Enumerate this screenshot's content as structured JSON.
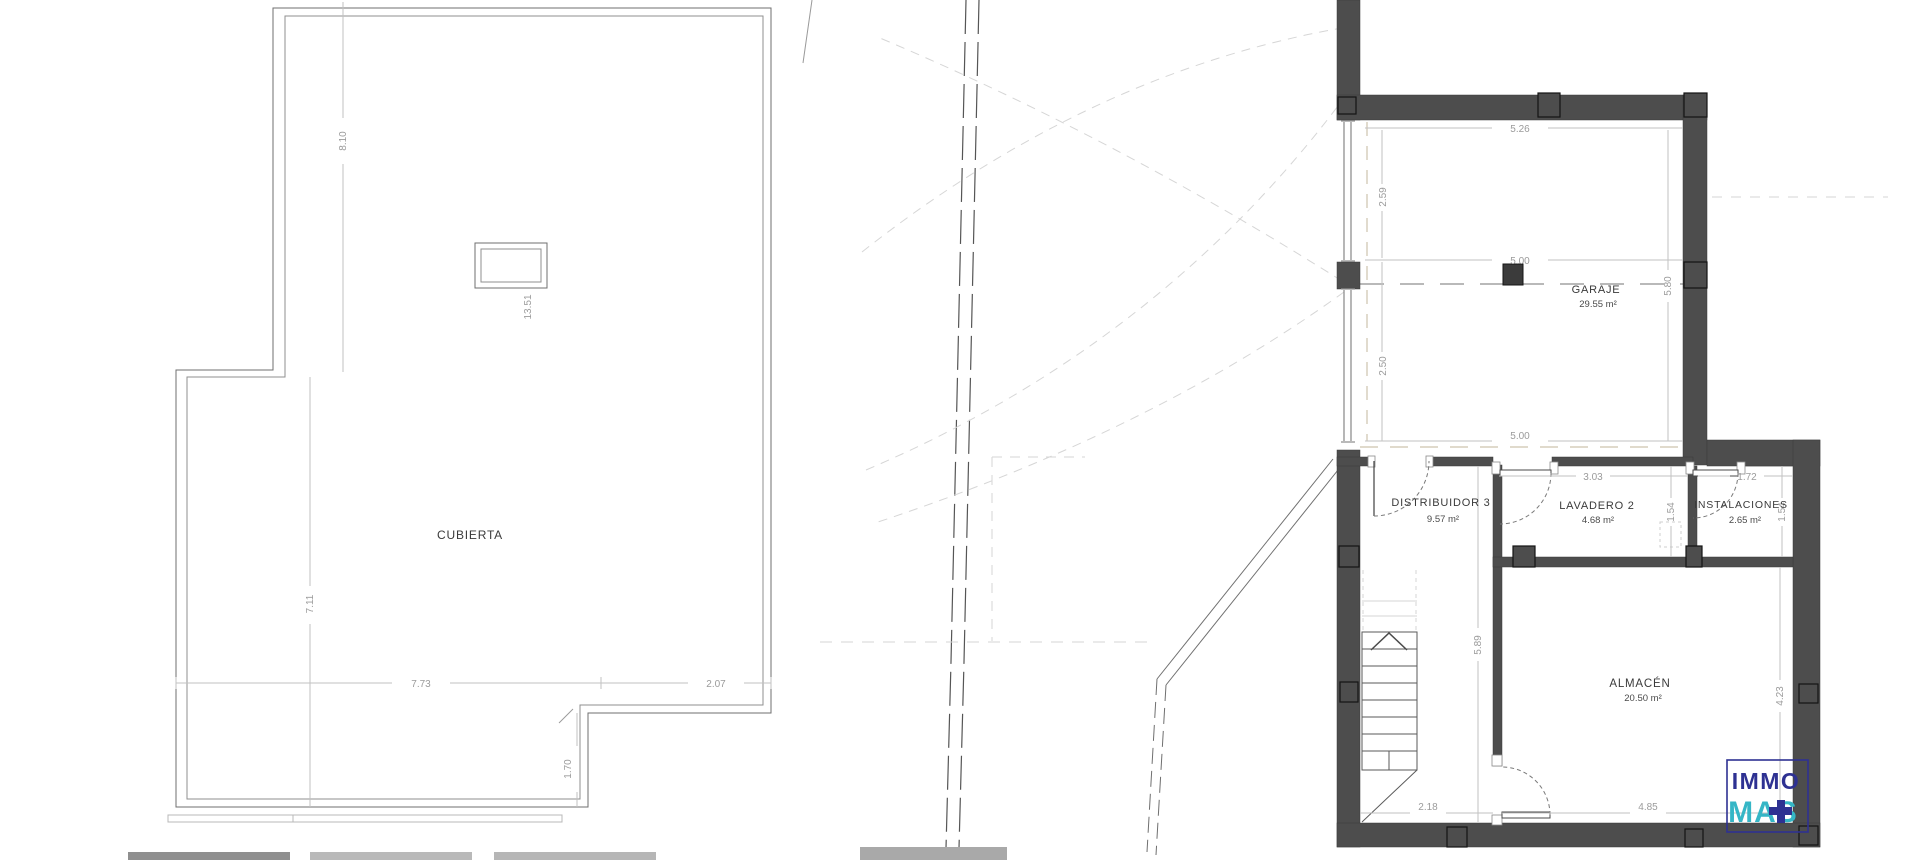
{
  "roof_plan": {
    "room_label": "CUBIERTA",
    "dims": {
      "height_upper": "8.10",
      "chimney": "13.51",
      "height_lower": "7.11",
      "width_main": "7.73",
      "width_right": "2.07",
      "notch": "1.70"
    }
  },
  "floor_plan": {
    "rooms": [
      {
        "name": "GARAJE",
        "area": "29.55 m²"
      },
      {
        "name": "DISTRIBUIDOR 3",
        "area": "9.57 m²"
      },
      {
        "name": "LAVADERO 2",
        "area": "4.68 m²"
      },
      {
        "name": "INSTALACIONES",
        "area": "2.65 m²"
      },
      {
        "name": "ALMACÉN",
        "area": "20.50 m²"
      }
    ],
    "dims": {
      "garage_top": "5.26",
      "garage_left_upper": "2.59",
      "garage_mid": "5.00",
      "garage_left_lower": "2.50",
      "garage_bottom": "5.00",
      "garage_right": "5.80",
      "lavadero_width": "3.03",
      "instalaciones_width": "1.72",
      "lavadero_height": "1.54",
      "instalaciones_height": "1.54",
      "distribuidor_height": "5.89",
      "stair_width": "2.18",
      "almacen_width": "4.85",
      "almacen_height": "4.23"
    }
  },
  "logo": {
    "line1": "IMMO",
    "line2": "MAS"
  },
  "colors": {
    "wall": "#4d4d4d",
    "logo_blue": "#2e3192",
    "logo_teal": "#35b6c6"
  }
}
